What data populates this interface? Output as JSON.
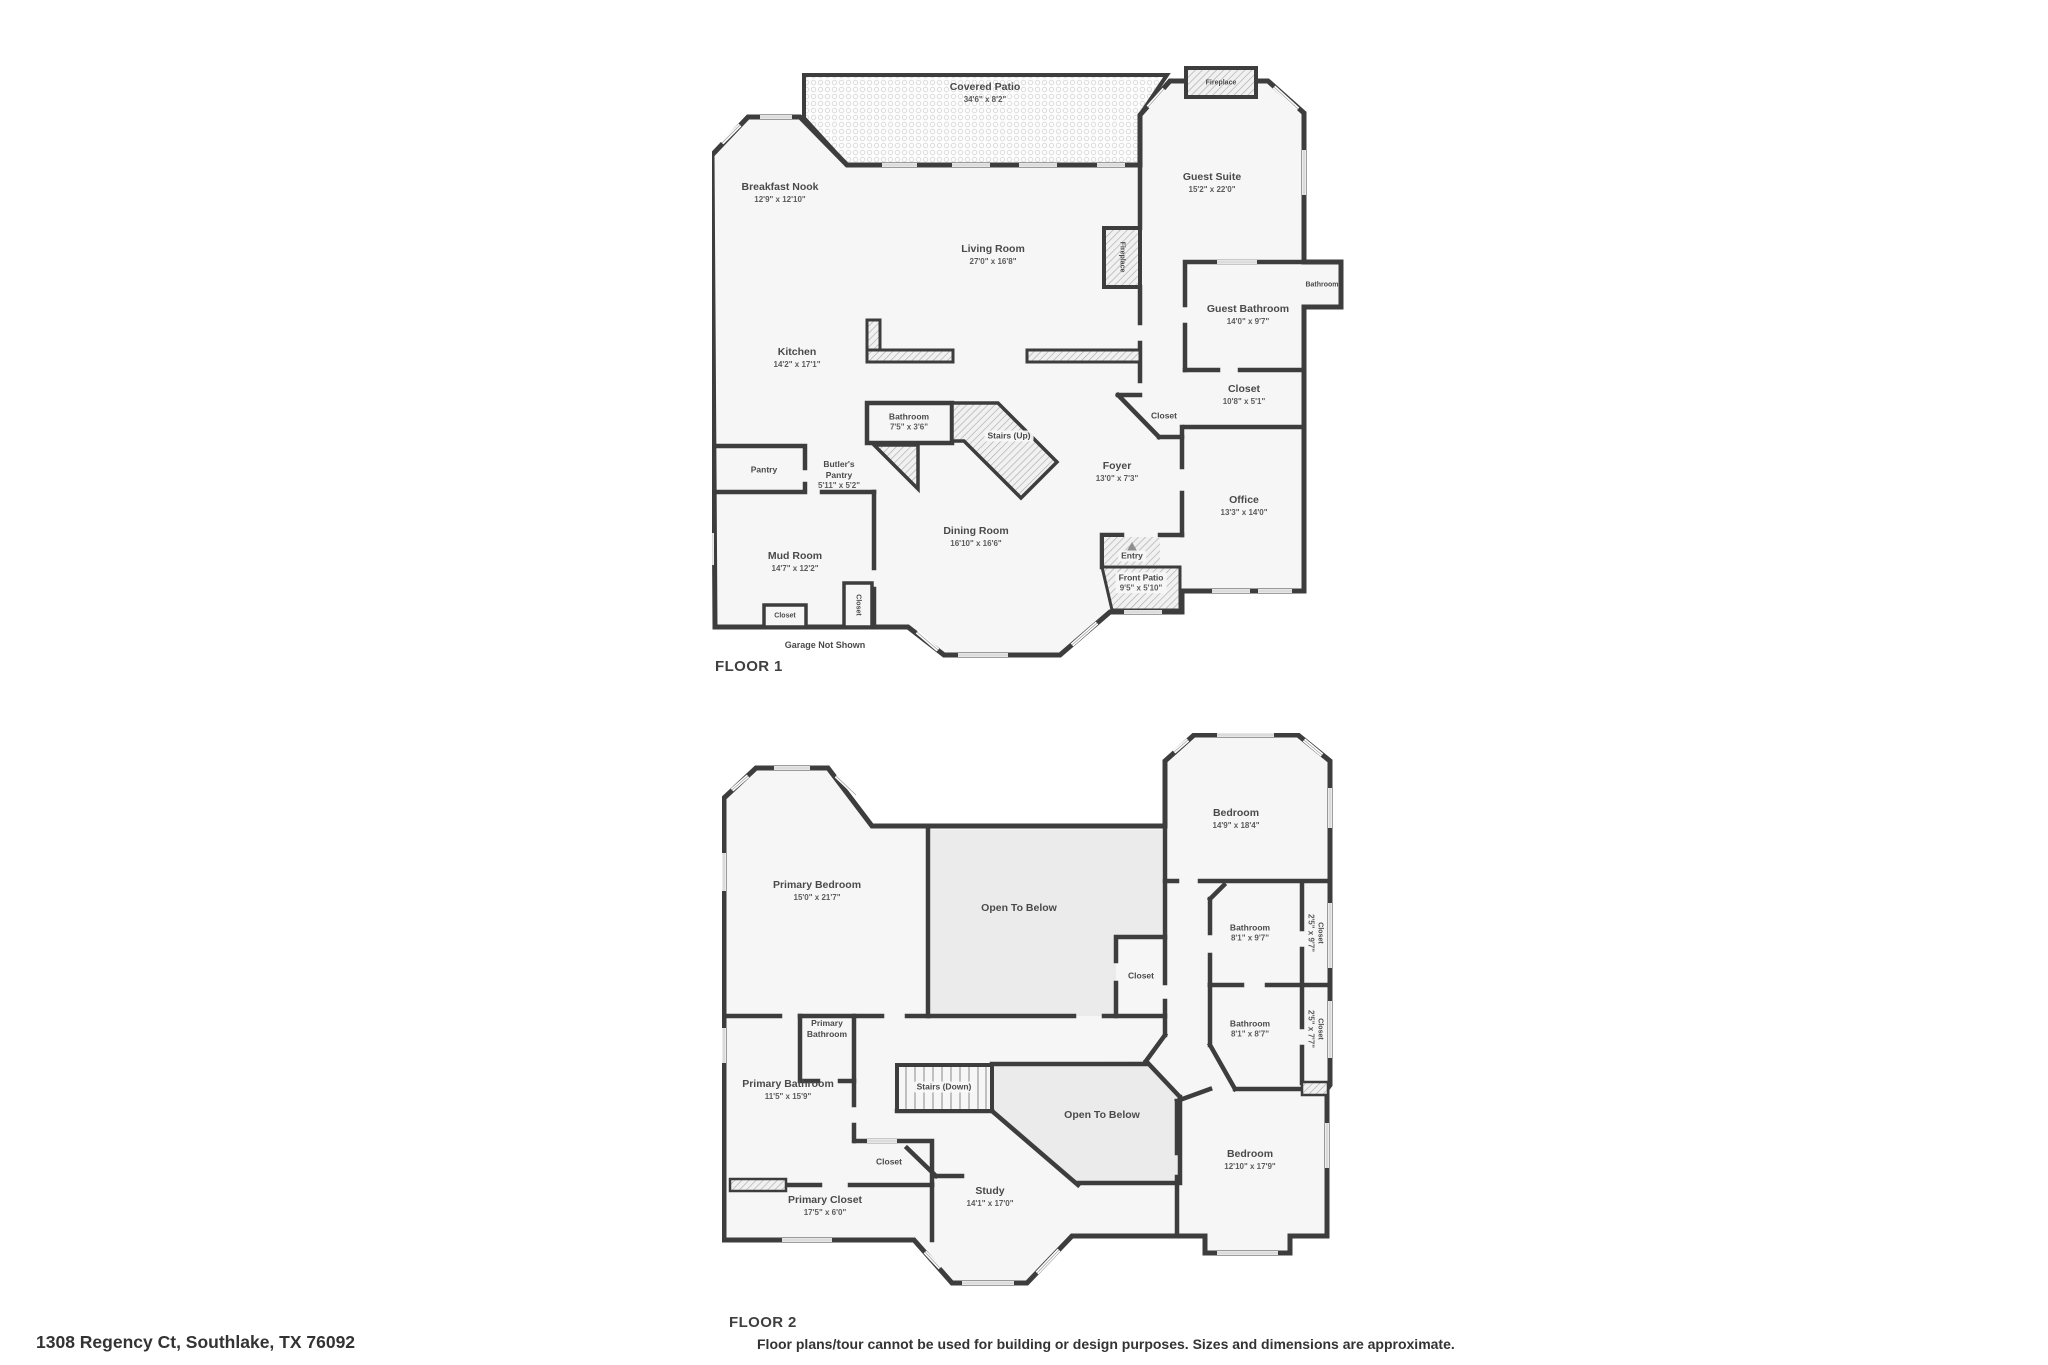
{
  "colors": {
    "wall": "#3d3d3d",
    "room_fill": "#f6f6f6",
    "open_below_fill": "#ebebeb",
    "label": "#4a4a4a"
  },
  "floor1": {
    "label": "FLOOR 1",
    "garage_note": "Garage Not Shown",
    "rooms": {
      "covered_patio": {
        "name": "Covered Patio",
        "dims": "34'6\" x 8'2\""
      },
      "breakfast_nook": {
        "name": "Breakfast Nook",
        "dims": "12'9\" x 12'10\""
      },
      "guest_suite": {
        "name": "Guest Suite",
        "dims": "15'2\" x 22'0\""
      },
      "living_room": {
        "name": "Living Room",
        "dims": "27'0\" x 16'8\""
      },
      "kitchen": {
        "name": "Kitchen",
        "dims": "14'2\" x 17'1\""
      },
      "fireplace_top": {
        "name": "Fireplace"
      },
      "fireplace_living": {
        "name": "Fireplace"
      },
      "bathroom_small": {
        "name": "Bathroom"
      },
      "guest_bathroom": {
        "name": "Guest Bathroom",
        "dims": "14'0\" x 9'7\""
      },
      "closet_guest": {
        "name": "Closet",
        "dims": "10'8\" x 5'1\""
      },
      "bathroom_center": {
        "name": "Bathroom",
        "dims": "7'5\" x 3'6\""
      },
      "stairs_up": {
        "name": "Stairs (Up)"
      },
      "butlers_pantry": {
        "name": "Butler's Pantry",
        "dims": "5'11\" x 5'2\""
      },
      "pantry": {
        "name": "Pantry"
      },
      "foyer": {
        "name": "Foyer",
        "dims": "13'0\" x 7'3\""
      },
      "office": {
        "name": "Office",
        "dims": "13'3\" x 14'0\""
      },
      "dining_room": {
        "name": "Dining Room",
        "dims": "16'10\" x 16'6\""
      },
      "mud_room": {
        "name": "Mud Room",
        "dims": "14'7\" x 12'2\""
      },
      "entry": {
        "name": "Entry"
      },
      "front_patio": {
        "name": "Front Patio",
        "dims": "9'5\" x 5'10\""
      },
      "closet_foyer": {
        "name": "Closet"
      },
      "closet_mud_h": {
        "name": "Closet"
      },
      "closet_mud_v": {
        "name": "Closet"
      }
    }
  },
  "floor2": {
    "label": "FLOOR 2",
    "rooms": {
      "primary_bedroom": {
        "name": "Primary Bedroom",
        "dims": "15'0\" x 21'7\""
      },
      "open_below_top": {
        "name": "Open To Below"
      },
      "bedroom_top": {
        "name": "Bedroom",
        "dims": "14'9\" x 18'4\""
      },
      "bathroom_top": {
        "name": "Bathroom",
        "dims": "8'1\" x 9'7\""
      },
      "closet_top_v": {
        "name": "Closet",
        "dims": "2'5\" x 9'7\""
      },
      "closet_mid": {
        "name": "Closet"
      },
      "bathroom_bottom": {
        "name": "Bathroom",
        "dims": "8'1\" x 8'7\""
      },
      "closet_bottom_v": {
        "name": "Closet",
        "dims": "2'5\" x 7'7\""
      },
      "primary_bathroom_small": {
        "name": "Primary Bathroom"
      },
      "primary_bathroom": {
        "name": "Primary Bathroom",
        "dims": "11'5\" x 15'9\""
      },
      "stairs_down": {
        "name": "Stairs (Down)"
      },
      "open_below_mid": {
        "name": "Open To Below"
      },
      "closet_small": {
        "name": "Closet"
      },
      "primary_closet": {
        "name": "Primary Closet",
        "dims": "17'5\" x 6'0\""
      },
      "study": {
        "name": "Study",
        "dims": "14'1\" x 17'0\""
      },
      "bedroom_bottom": {
        "name": "Bedroom",
        "dims": "12'10\" x 17'9\""
      }
    }
  },
  "footer": {
    "address": "1308 Regency Ct, Southlake, TX 76092",
    "disclaimer": "Floor plans/tour cannot be used for building or design purposes. Sizes and dimensions are approximate."
  }
}
